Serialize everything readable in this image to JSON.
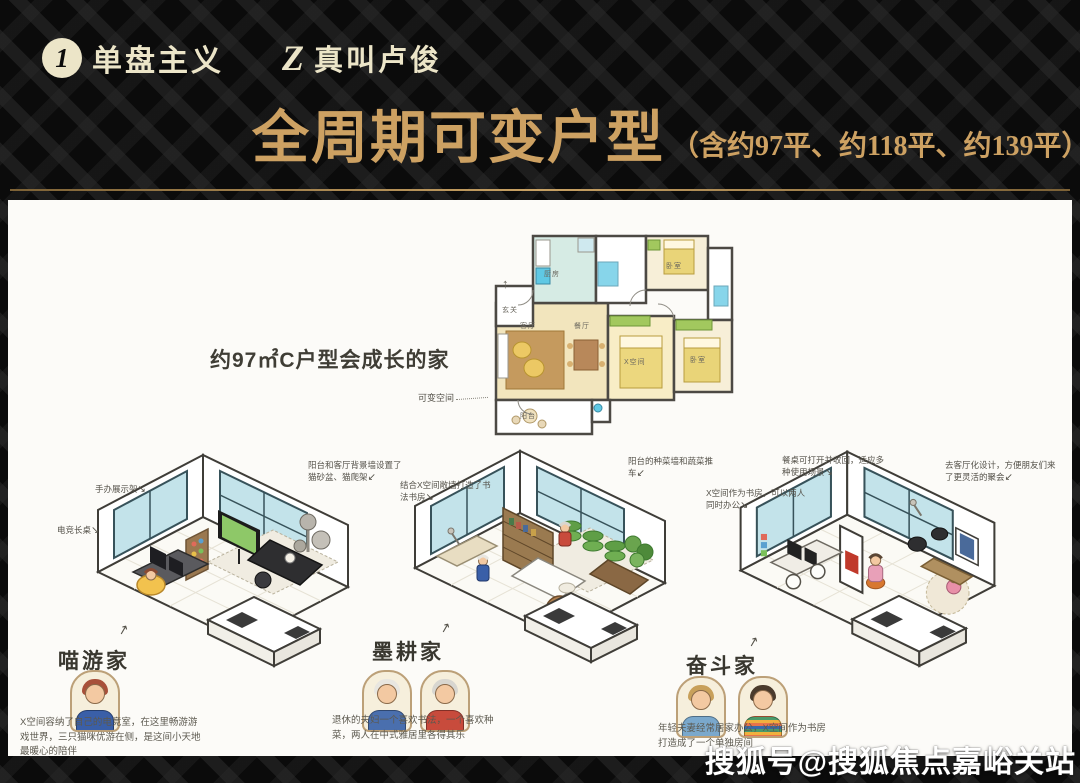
{
  "header": {
    "logo1_icon": "1",
    "logo1": "单盘主义",
    "logo2_icon": "Z",
    "logo2": "真叫卢俊",
    "title": "全周期可变户型",
    "subtitle": "（含约97平、约118平、约139平）"
  },
  "floorplan": {
    "caption": "约97㎡C户型会成长的家",
    "variable_space_label": "可变空间",
    "rooms": {
      "entry": "玄关",
      "kitchen": "厨房",
      "bedroom_top": "卧室",
      "living": "客厅",
      "dining": "餐厅",
      "x_space": "X空间",
      "bedroom_right": "卧室",
      "balcony": "阳台"
    }
  },
  "scenes": [
    {
      "name": "喵游家",
      "annotations": [
        "手办展示架",
        "电竞长桌",
        "阳台和客厅背景墙设置了猫砂盆、猫爬架"
      ],
      "description": "X空间容纳了自己的电竞室，在这里畅游游戏世界，三只猫咪优游在侧，是这间小天地最暖心的陪伴"
    },
    {
      "name": "墨耕家",
      "annotations": [
        "结合X空间敞墙打造了书法书房",
        "阳台的种菜墙和蔬菜推车"
      ],
      "description": "退休的夫妇一个喜欢书法，一个喜欢种菜，两人在中式雅居里各得其乐"
    },
    {
      "name": "奋斗家",
      "annotations": [
        "餐桌可打开并收回，适应多种使用场景",
        "去客厅化设计，方便朋友们来了更灵活的聚会",
        "X空间作为书房，可以两人同时办公"
      ],
      "description": "年轻夫妻经常居家办公，X空间作为书房打造成了一个单独房间"
    }
  ],
  "icons": {
    "north_arrow": "↑",
    "arrow_down_right": "↘",
    "arrow_down_left": "↙",
    "arrow_up_right": "↗"
  },
  "watermark": "搜狐号@搜狐焦点嘉峪关站",
  "colors": {
    "gold": "#cda162",
    "cream": "#ece5c8",
    "background": "#0b0b0b",
    "panel": "#fcfbf8",
    "teal_window": "#c3e3ea",
    "plan_yellow": "#e9d478",
    "plan_green": "#a2c85e"
  }
}
